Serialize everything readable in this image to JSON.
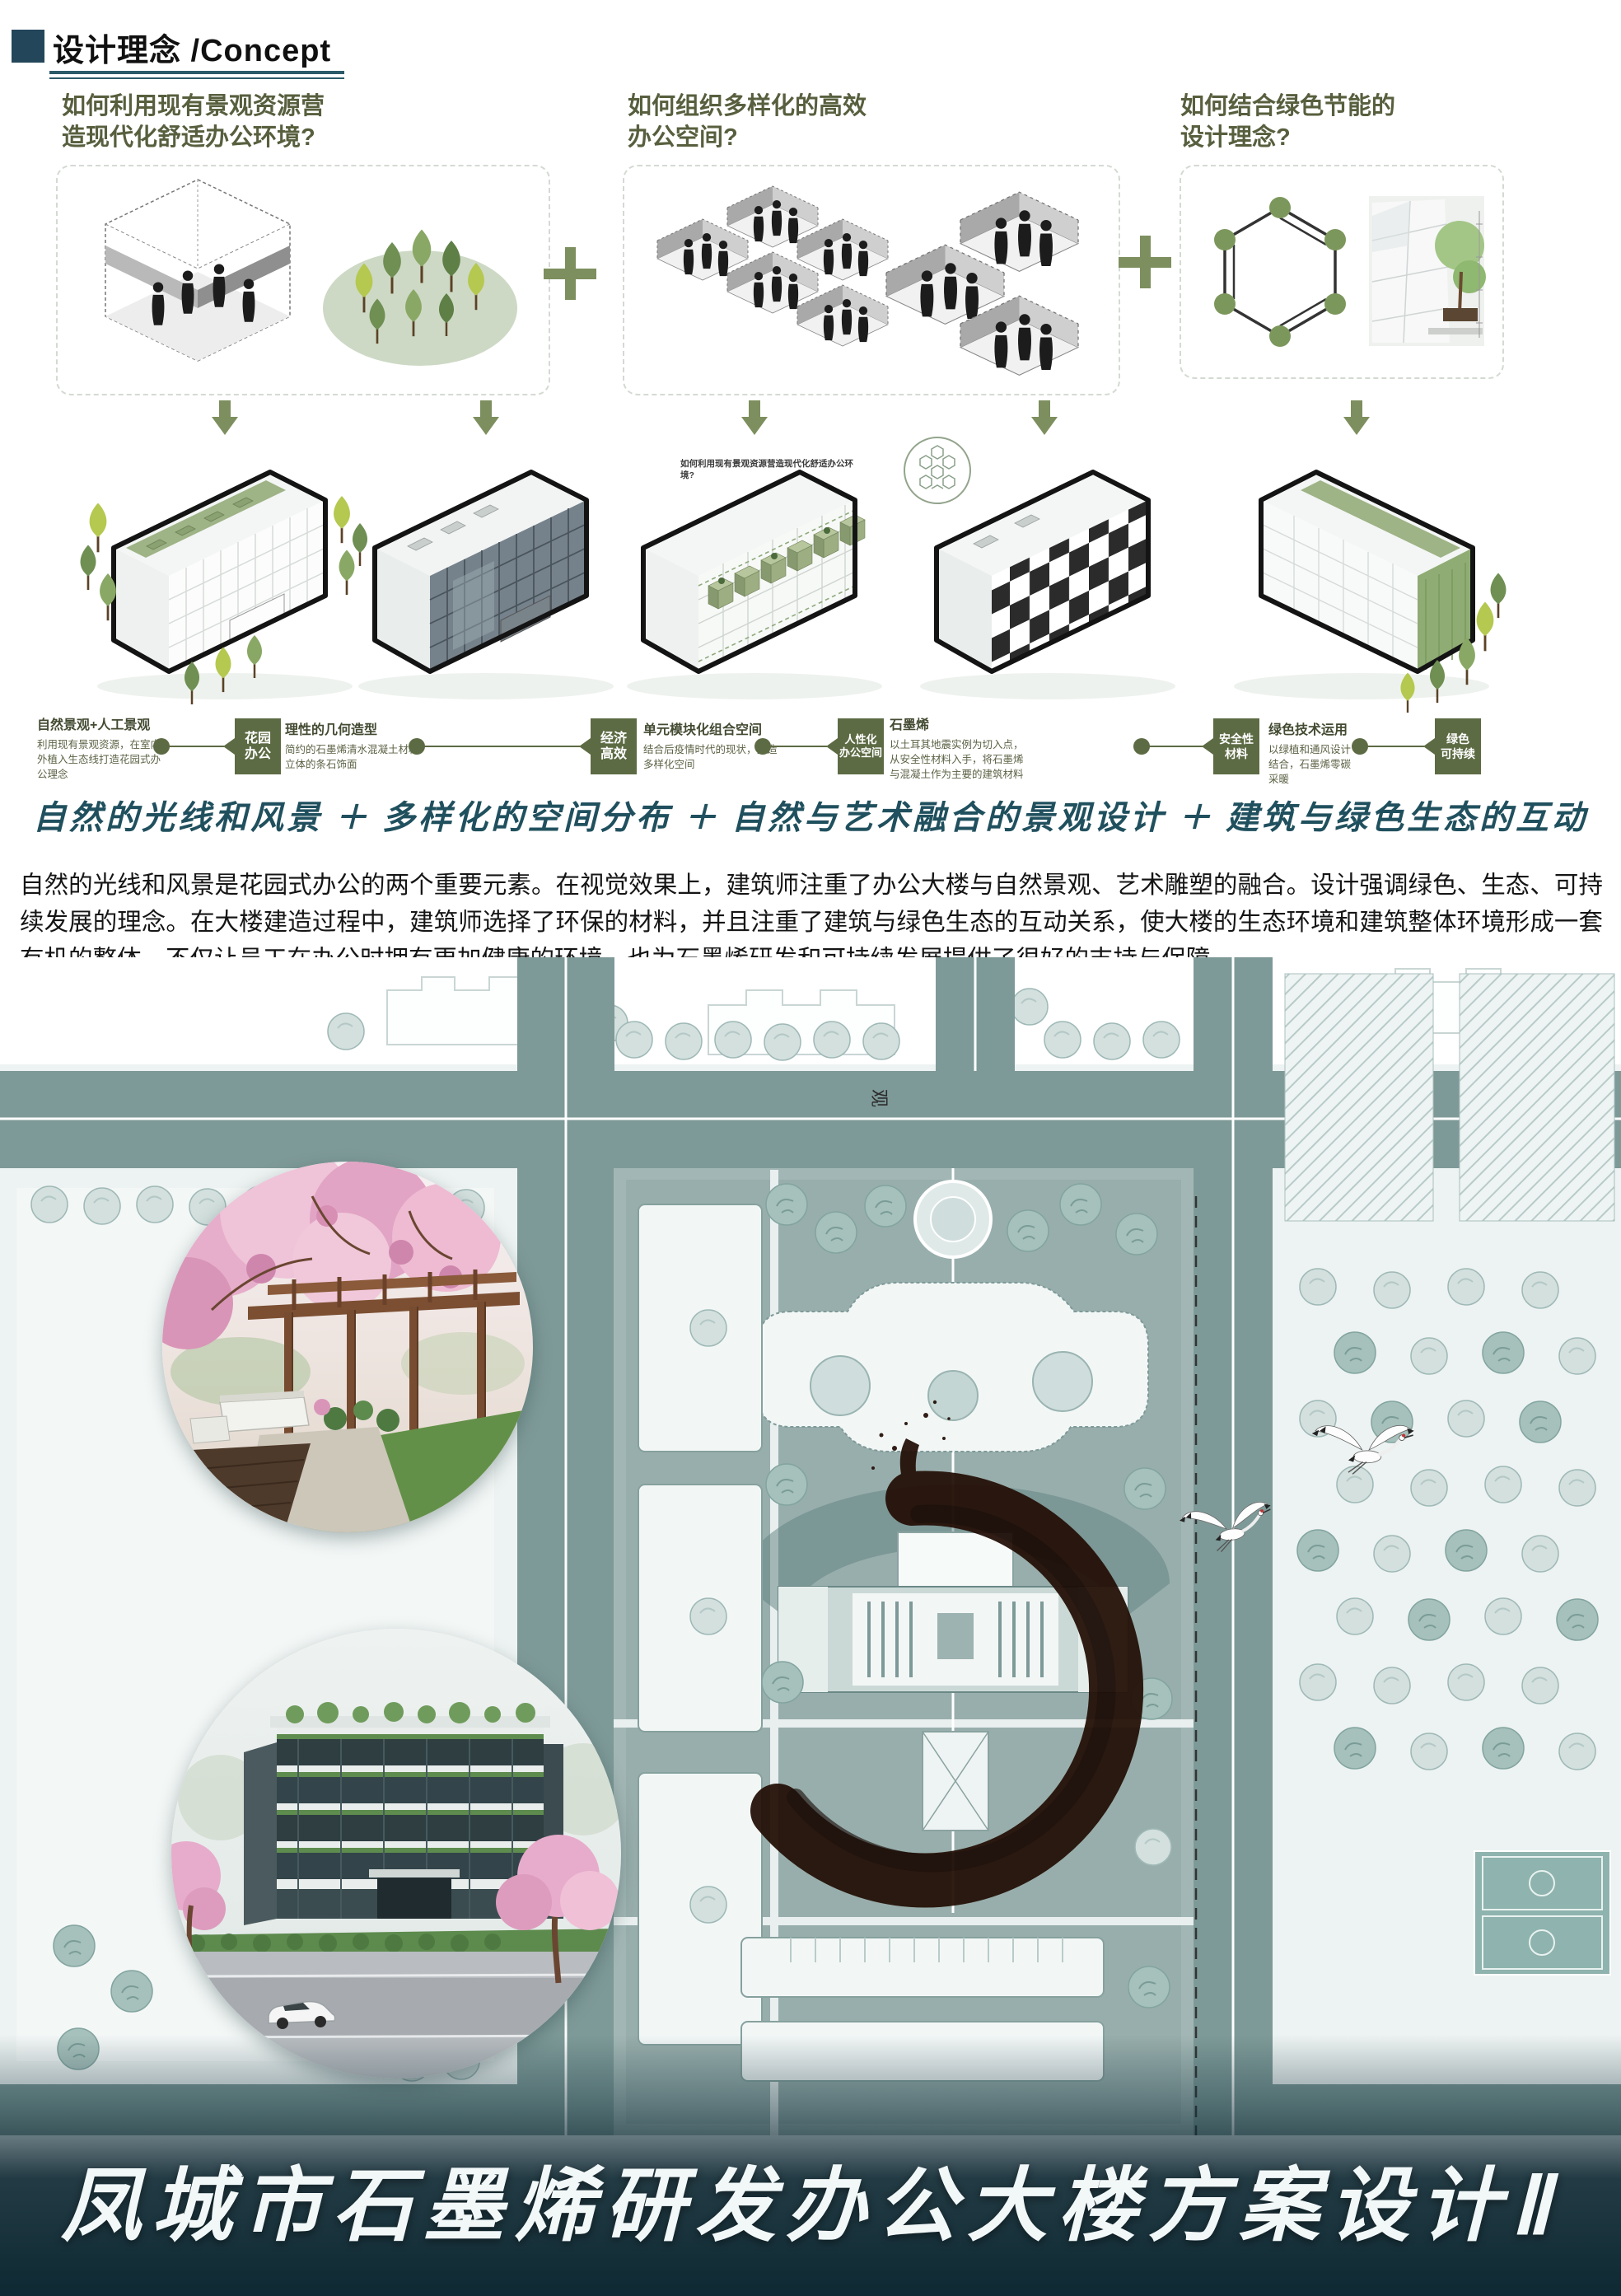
{
  "header": {
    "title": "设计理念 /Concept"
  },
  "questions": [
    {
      "line1": "如何利用现有景观资源营",
      "line2": "造现代化舒适办公环境?"
    },
    {
      "line1": "如何组织多样化的高效",
      "line2": "办公空间?"
    },
    {
      "line1": "如何结合绿色节能的",
      "line2": "设计理念?"
    }
  ],
  "concept_chain": {
    "blocks": [
      {
        "title": "自然景观+人工景观",
        "desc": "利用现有景观资源，在室内外植入生态线打造花园式办公理念"
      },
      {
        "title": "理性的几何造型",
        "desc": "简约的石墨烯清水混凝土材料 立体的条石饰面"
      },
      {
        "title": "单元模块化组合空间",
        "desc": "结合后疫情时代的现状，打造多样化空间"
      },
      {
        "title": "石墨烯",
        "desc": "以土耳其地震实例为切入点，从安全性材料入手，将石墨烯与混凝土作为主要的建筑材料"
      },
      {
        "title": "绿色技术运用",
        "desc": "以绿植和通风设计结合，石墨烯零碳采暖"
      }
    ],
    "nodes": [
      {
        "line1": "花园",
        "line2": "办公"
      },
      {
        "line1": "经济",
        "line2": "高效"
      },
      {
        "line1": "人性化",
        "line2": "办公空间"
      },
      {
        "line1": "安全性",
        "line2": "材料"
      },
      {
        "line1": "绿色",
        "line2": "可持续"
      }
    ]
  },
  "axon_note": "如何利用现有景观资源营造现代化舒适办公环境?",
  "handwritten_line": "自然的光线和风景 ＋ 多样化的空间分布 ＋ 自然与艺术融合的景观设计 ＋ 建筑与绿色生态的互动",
  "summary_paragraph": "自然的光线和风景是花园式办公的两个重要元素。在视觉效果上，建筑师注重了办公大楼与自然景观、艺术雕塑的融合。设计强调绿色、生态、可持续发展的理念。在大楼建造过程中，建筑师选择了环保的材料，并且注重了建筑与绿色生态的互动关系，使大楼的生态环境和建筑整体环境形成一套有机的整体，不仅让员工在办公时拥有更加健康的环境，也为石墨烯研发和可持续发展提供了很好的支持与保障。",
  "site_plan": {
    "road_label": "观"
  },
  "footer": {
    "project_title": "凤城市石墨烯研发办公大楼方案设计Ⅱ"
  },
  "colors": {
    "accent_green": "#7d8f5e",
    "node_green": "#5d6b44",
    "header_teal": "#23465a",
    "question_olive": "#575f3e",
    "handwritten_teal": "#20505e",
    "road_teal": "#7e9a98",
    "ink": "#241007",
    "footer_dark": "#0e2933"
  }
}
